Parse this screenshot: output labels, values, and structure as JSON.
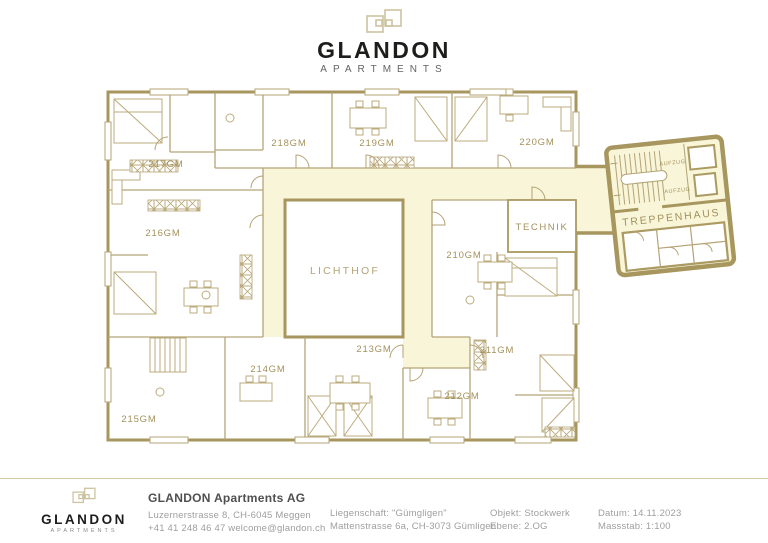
{
  "brand": {
    "name": "GLANDON",
    "tagline": "APARTMENTS"
  },
  "plan": {
    "units": [
      {
        "label": "210GM"
      },
      {
        "label": "211GM"
      },
      {
        "label": "212GM"
      },
      {
        "label": "213GM"
      },
      {
        "label": "214GM"
      },
      {
        "label": "215GM"
      },
      {
        "label": "216GM"
      },
      {
        "label": "217GM"
      },
      {
        "label": "218GM"
      },
      {
        "label": "219GM"
      },
      {
        "label": "220GM"
      }
    ],
    "areas": {
      "lichthof": "LICHTHOF",
      "technik": "TECHNIK",
      "treppenhaus": "TREPPENHAUS",
      "aufzug": "AUFZUG"
    }
  },
  "footer": {
    "company": {
      "name": "GLANDON Apartments AG",
      "address": "Luzernerstrasse 8, CH-6045 Meggen",
      "contact": "+41 41 248 46 47 welcome@glandon.ch"
    },
    "property": {
      "line1": "Liegenschaft: \"Gümgligen\"",
      "line2": "Mattenstrasse 6a, CH-3073 Gümligen"
    },
    "object": {
      "line1": "Objekt: Stockwerk",
      "line2": "Ebene:  2.OG"
    },
    "meta": {
      "line1": "Datum: 14.11.2023",
      "line2": "Massstab: 1:100"
    }
  },
  "colors": {
    "wall": "#b4a376",
    "wall_dark": "#a7965e",
    "corridor": "#f8f5d8",
    "label": "#a6965f",
    "ink": "#1d1d1b",
    "muted": "#9b9b9b"
  }
}
